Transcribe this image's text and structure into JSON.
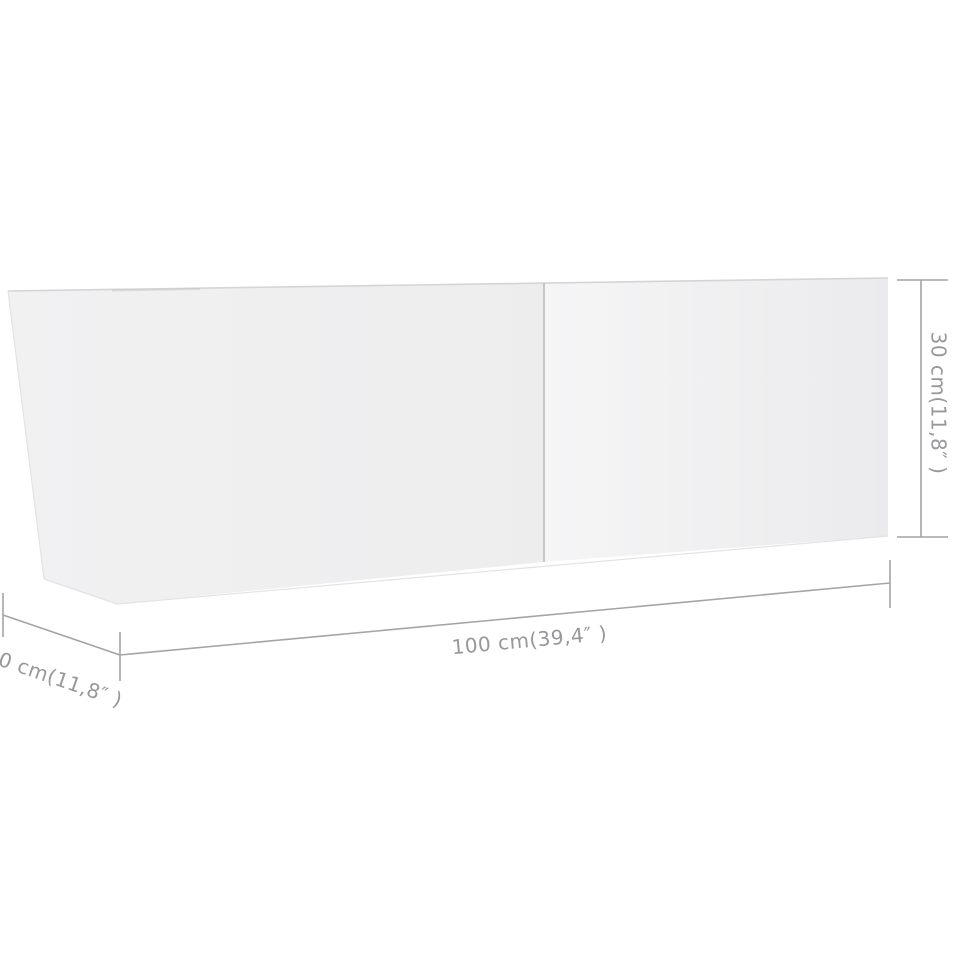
{
  "diagram": {
    "kind": "product-dimension-diagram",
    "subject": "wall-mounted tv cabinet with two front panels, shown in perspective",
    "labels": {
      "width": "100 cm(39,4″ )",
      "height": "30 cm(11,8″ )",
      "depth": "0 cm(11,8″ )"
    },
    "colors": {
      "background": "#ffffff",
      "panel_left": "#efeff0",
      "panel_right_light": "#f5f5f6",
      "panel_right_dark": "#ebebed",
      "top_edge": "#d4d4d6",
      "panel_divider": "#bdbdbf",
      "dimension_line": "#a4a4a7",
      "dimension_text": "#98989b"
    }
  }
}
